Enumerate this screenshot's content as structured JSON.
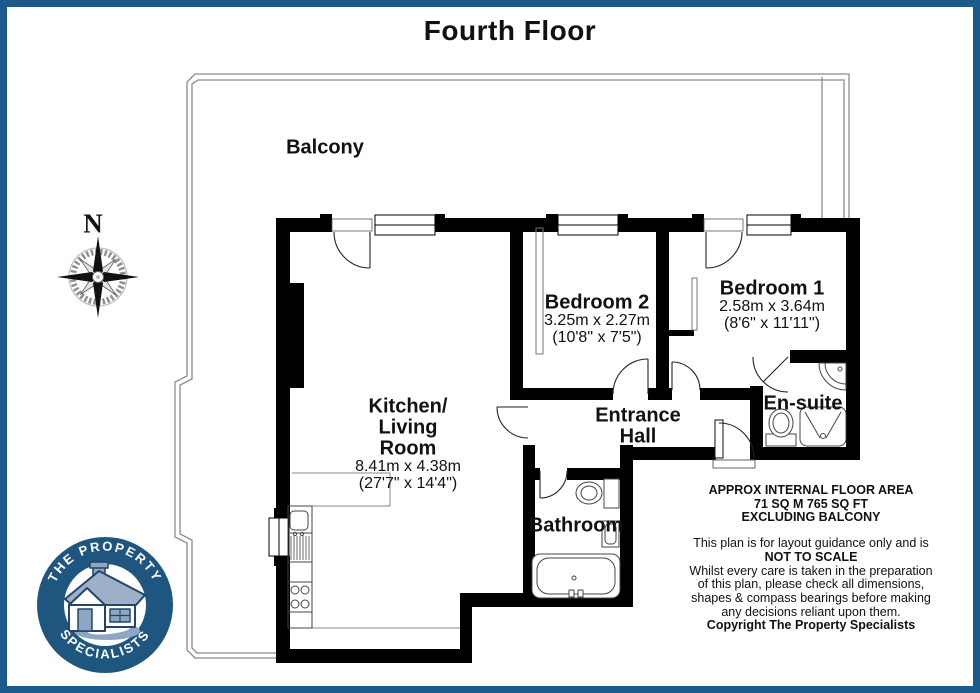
{
  "title": "Fourth Floor",
  "compass": {
    "north_label": "N"
  },
  "balcony": {
    "label": "Balcony"
  },
  "rooms": {
    "bedroom2": {
      "name": "Bedroom 2",
      "dims_metric": "3.25m x 2.27m",
      "dims_imperial": "(10'8\" x 7'5\")"
    },
    "bedroom1": {
      "name": "Bedroom 1",
      "dims_metric": "2.58m x 3.64m",
      "dims_imperial": "(8'6\" x 11'11\")"
    },
    "kitchen_living": {
      "name_line1": "Kitchen/",
      "name_line2": "Living",
      "name_line3": "Room",
      "dims_metric": "8.41m x 4.38m",
      "dims_imperial": "(27'7\" x 14'4\")"
    },
    "entrance_hall": {
      "name_line1": "Entrance",
      "name_line2": "Hall"
    },
    "ensuite": {
      "name": "En-suite"
    },
    "bathroom": {
      "name": "Bathroom"
    }
  },
  "footer": {
    "area_line1": "APPROX INTERNAL FLOOR AREA",
    "area_line2": "71 SQ M 765 SQ FT",
    "area_line3": "EXCLUDING BALCONY",
    "disclaimer_line1": "This plan is for layout guidance only and is",
    "not_to_scale": "NOT TO SCALE",
    "disclaimer_line2": "Whilst every care is taken in the preparation",
    "disclaimer_line3": "of this plan, please check all dimensions,",
    "disclaimer_line4": "shapes & compass bearings before making",
    "disclaimer_line5": "any decisions reliant upon them.",
    "copyright": "Copyright The Property Specialists"
  },
  "logo": {
    "arc_top": "THE PROPERTY",
    "arc_bottom": "SPECIALISTS"
  },
  "colors": {
    "frame_blue": "#1b5a8a",
    "logo_blue": "#1f567f",
    "wall_black": "#000000",
    "balcony_line": "#8a8a8a"
  }
}
